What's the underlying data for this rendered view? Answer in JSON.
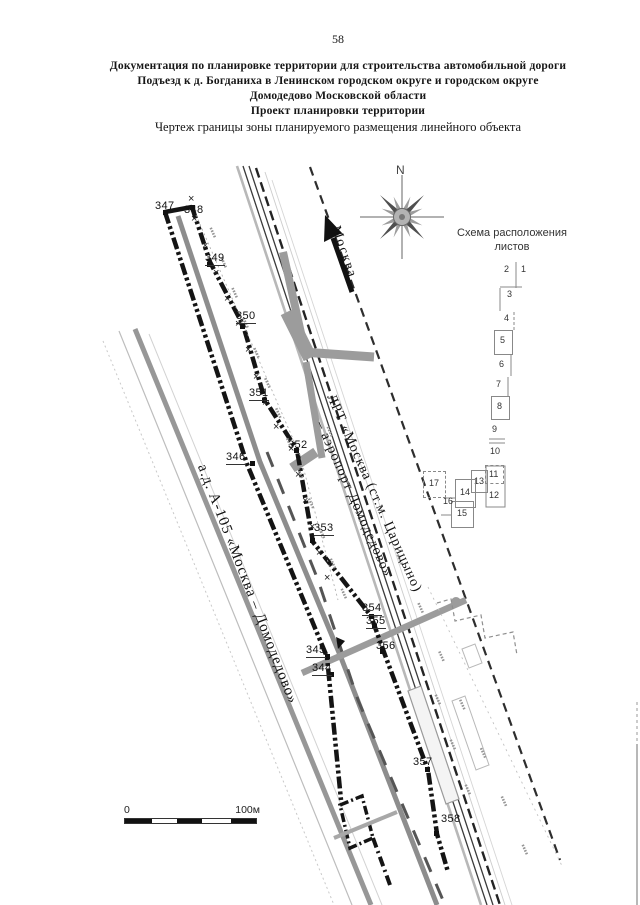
{
  "page_number": "58",
  "header": {
    "line1": "Документация по планировке территории для строительства автомобильной дороги",
    "line2": "Подъезд к д. Богданиха в Ленинском городском округе и городском округе",
    "line3": "Домодедово Московской области",
    "line4": "Проект планировки территории",
    "line5": "Чертеж границы зоны планируемого размещения линейного объекта"
  },
  "compass": {
    "north_label": "N"
  },
  "arrow_label": "Москва",
  "sheet_scheme": {
    "title_line1": "Схема расположения",
    "title_line2": "листов",
    "sheets": [
      {
        "n": "1",
        "x": 521,
        "y": 265
      },
      {
        "n": "2",
        "x": 504,
        "y": 265
      },
      {
        "n": "3",
        "x": 507,
        "y": 290
      },
      {
        "n": "4",
        "x": 504,
        "y": 314
      },
      {
        "n": "5",
        "x": 500,
        "y": 336,
        "box": {
          "x": 494,
          "y": 330,
          "w": 17,
          "h": 23,
          "style": "solid"
        }
      },
      {
        "n": "6",
        "x": 499,
        "y": 360
      },
      {
        "n": "7",
        "x": 496,
        "y": 380
      },
      {
        "n": "8",
        "x": 497,
        "y": 402,
        "box": {
          "x": 491,
          "y": 396,
          "w": 17,
          "h": 22,
          "style": "solid"
        }
      },
      {
        "n": "9",
        "x": 492,
        "y": 425
      },
      {
        "n": "10",
        "x": 490,
        "y": 447
      },
      {
        "n": "11",
        "x": 489,
        "y": 470,
        "box": {
          "x": 485,
          "y": 465,
          "w": 17,
          "h": 17,
          "style": "dashed"
        }
      },
      {
        "n": "12",
        "x": 489,
        "y": 491
      },
      {
        "n": "13",
        "x": 474,
        "y": 477,
        "box": {
          "x": 471,
          "y": 470,
          "w": 15,
          "h": 21,
          "style": "solid"
        }
      },
      {
        "n": "14",
        "x": 460,
        "y": 488,
        "box": {
          "x": 455,
          "y": 479,
          "w": 19,
          "h": 27,
          "style": "solid"
        }
      },
      {
        "n": "15",
        "x": 457,
        "y": 509,
        "box": {
          "x": 451,
          "y": 501,
          "w": 21,
          "h": 25,
          "style": "solid"
        }
      },
      {
        "n": "16",
        "x": 443,
        "y": 497
      },
      {
        "n": "17",
        "x": 429,
        "y": 479,
        "box": {
          "x": 423,
          "y": 471,
          "w": 21,
          "h": 25,
          "style": "dashed"
        }
      }
    ]
  },
  "map": {
    "points": [
      {
        "id": "347",
        "lx": 155,
        "ly": 201,
        "mx": 165,
        "my": 212,
        "ul": false
      },
      {
        "id": "348",
        "lx": 184,
        "ly": 205,
        "mx": 192,
        "my": 207,
        "ul": false
      },
      {
        "id": "349",
        "lx": 205,
        "ly": 253,
        "mx": 209,
        "my": 264,
        "ul": true
      },
      {
        "id": "350",
        "lx": 236,
        "ly": 311,
        "mx": 242,
        "my": 326,
        "ul": true
      },
      {
        "id": "351",
        "lx": 249,
        "ly": 388,
        "mx": 264,
        "my": 400,
        "ul": true
      },
      {
        "id": "352",
        "lx": 288,
        "ly": 440,
        "mx": 296,
        "my": 450,
        "ul": false
      },
      {
        "id": "346",
        "lx": 226,
        "ly": 452,
        "mx": 252,
        "my": 463,
        "ul": true
      },
      {
        "id": "353",
        "lx": 314,
        "ly": 523,
        "mx": 312,
        "my": 540,
        "ul": true
      },
      {
        "id": "354",
        "lx": 362,
        "ly": 603,
        "mx": 371,
        "my": 616,
        "ul": true
      },
      {
        "id": "355",
        "lx": 366,
        "ly": 616,
        "mx": 374,
        "my": 626,
        "ul": true
      },
      {
        "id": "356",
        "lx": 376,
        "ly": 641,
        "mx": 382,
        "my": 651,
        "ul": false
      },
      {
        "id": "345",
        "lx": 306,
        "ly": 645,
        "mx": 327,
        "my": 656,
        "ul": true
      },
      {
        "id": "344",
        "lx": 312,
        "ly": 663,
        "mx": 331,
        "my": 674,
        "ul": true
      },
      {
        "id": "357",
        "lx": 413,
        "ly": 757,
        "mx": 427,
        "my": 769,
        "ul": false
      },
      {
        "id": "358",
        "lx": 441,
        "ly": 814,
        "mx": 436,
        "my": 833,
        "ul": false
      }
    ],
    "fence_marks": [
      [
        193,
        200
      ],
      [
        196,
        220
      ],
      [
        207,
        247
      ],
      [
        218,
        274
      ],
      [
        229,
        300
      ],
      [
        240,
        325
      ],
      [
        250,
        351
      ],
      [
        258,
        378
      ],
      [
        267,
        404
      ],
      [
        278,
        428
      ],
      [
        293,
        450
      ],
      [
        300,
        476
      ],
      [
        307,
        502
      ],
      [
        314,
        528
      ],
      [
        321,
        554
      ],
      [
        329,
        579
      ]
    ],
    "road_labels": [
      {
        "text": "ЛРТ «Москва (ст.м. Царицыно)",
        "x": 337,
        "y": 392,
        "angle": 66,
        "size": 14
      },
      {
        "text": "– аэропорт Домодедово»",
        "x": 326,
        "y": 419,
        "angle": 66,
        "size": 14
      },
      {
        "text": "а.д. А-105 «Москва – Домодедово»",
        "x": 209,
        "y": 462,
        "angle": 69,
        "size": 15
      }
    ],
    "scale_bar": {
      "zero": "0",
      "hundred": "100м"
    }
  }
}
